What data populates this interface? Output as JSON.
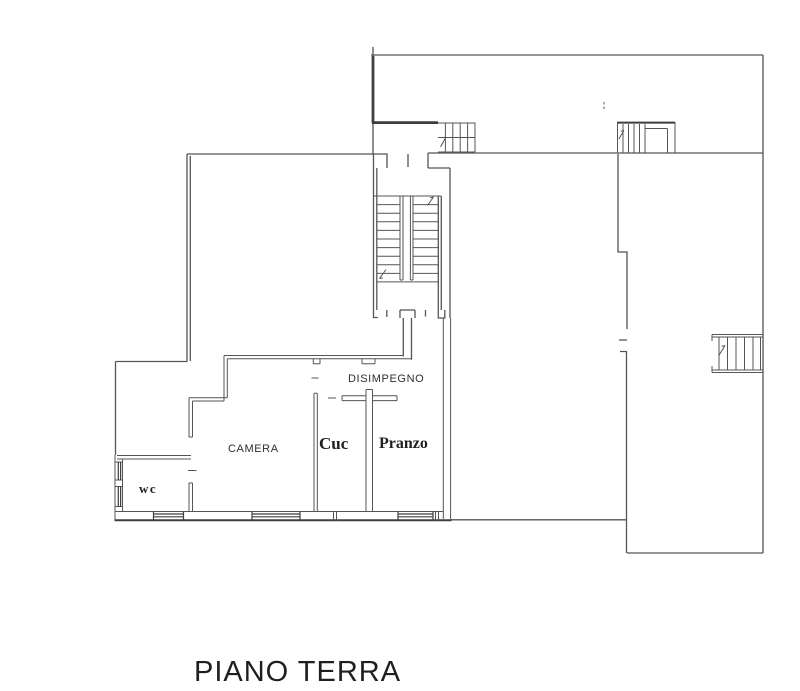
{
  "title": "PIANO TERRA",
  "rooms": {
    "disimpegno": "DISIMPEGNO",
    "camera": "CAMERA",
    "cucina": "Cuc",
    "pranzo": "Pranzo",
    "wc": "wc"
  },
  "colors": {
    "wall_line": "#555555",
    "wall_thick": "#3e3e3e",
    "label_text": "#2f2f2f",
    "title_text": "#1f1f1f",
    "background": "#ffffff"
  }
}
